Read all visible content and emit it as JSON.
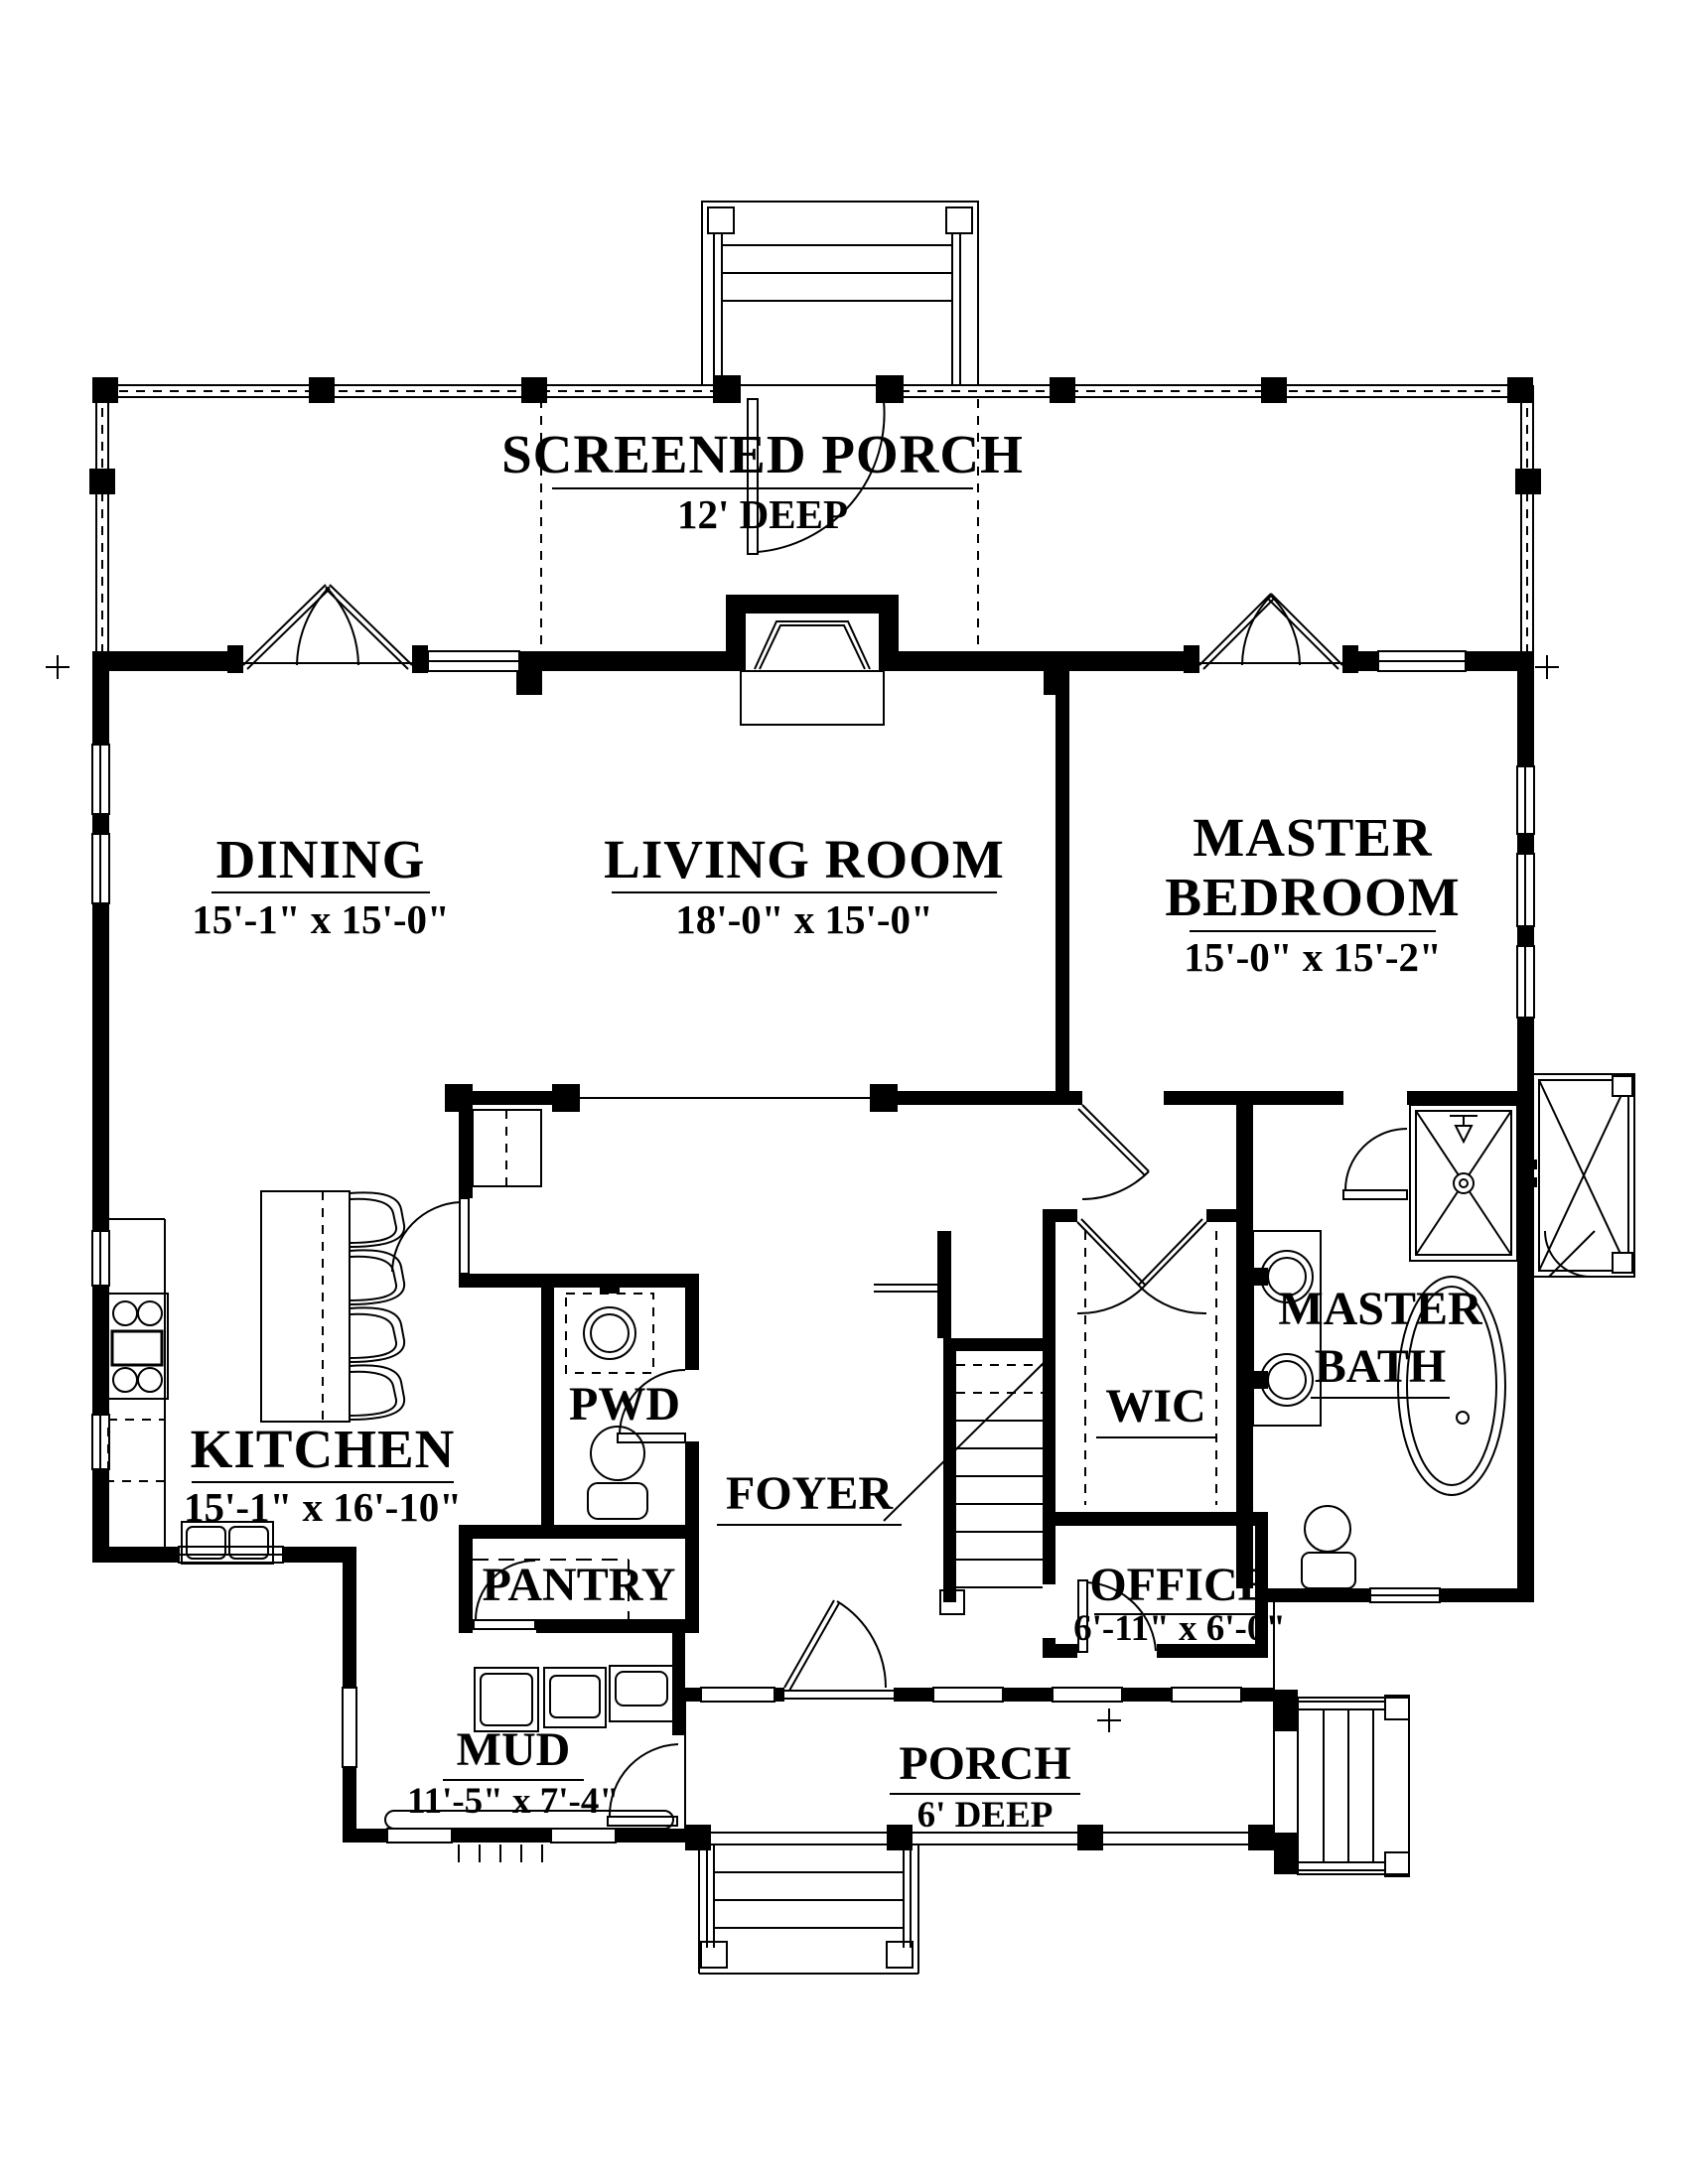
{
  "plan": {
    "colors": {
      "ink": "#000000",
      "paper": "#ffffff"
    },
    "rooms": {
      "screened_porch": {
        "name": "SCREENED PORCH",
        "dims": "12' DEEP"
      },
      "dining": {
        "name": "DINING",
        "dims": "15'-1\" x 15'-0\""
      },
      "living_room": {
        "name": "LIVING ROOM",
        "dims": "18'-0\" x 15'-0\""
      },
      "master_bedroom": {
        "line1": "MASTER",
        "line2": "BEDROOM",
        "dims": "15'-0\" x 15'-2\""
      },
      "kitchen": {
        "name": "KITCHEN",
        "dims": "15'-1\" x 16'-10\""
      },
      "pwd": {
        "name": "PWD"
      },
      "foyer": {
        "name": "FOYER"
      },
      "wic": {
        "name": "WIC"
      },
      "master_bath": {
        "line1": "MASTER",
        "line2": "BATH"
      },
      "pantry": {
        "name": "PANTRY"
      },
      "office": {
        "name": "OFFICE",
        "dims": "6'-11\" x 6'-0\""
      },
      "mud": {
        "name": "MUD",
        "dims": "11'-5\" x 7'-4\""
      },
      "porch": {
        "name": "PORCH",
        "dims": "6' DEEP"
      }
    }
  }
}
